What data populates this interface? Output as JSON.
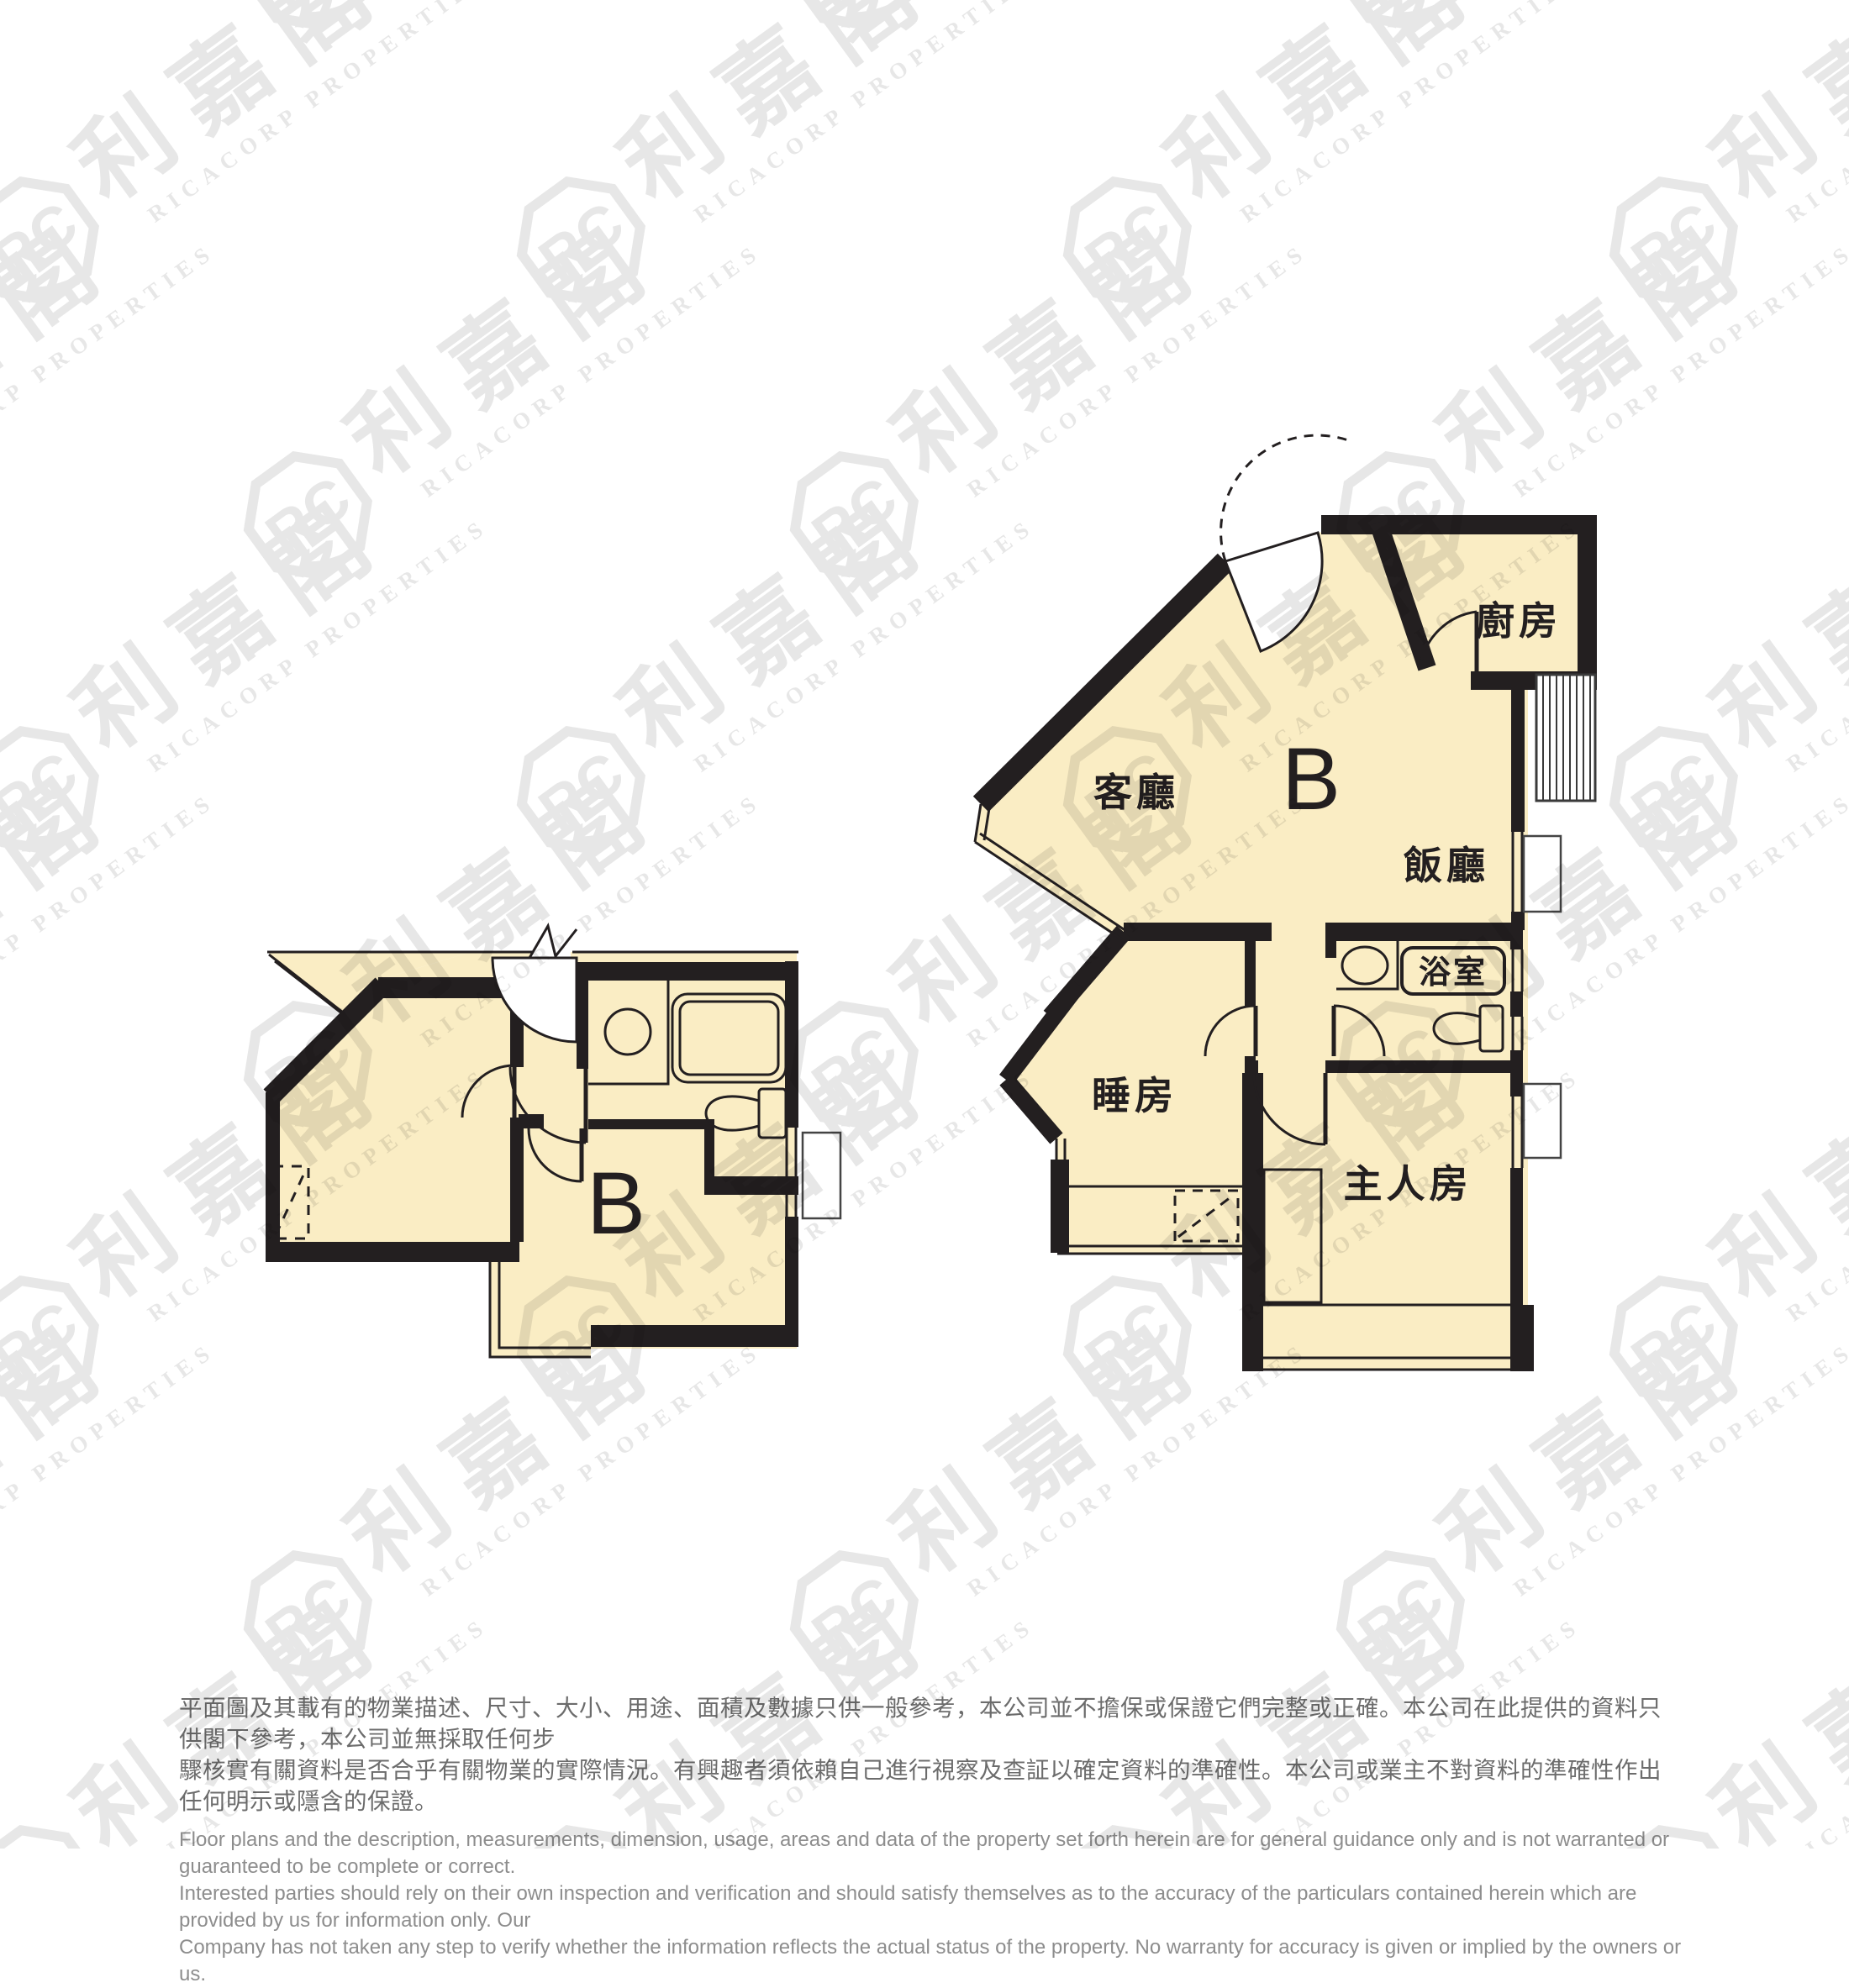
{
  "meta": {
    "background": "#ffffff",
    "wall_color": "#231f20",
    "floor_fill": "#faedc4",
    "thin_line_color": "#231f20",
    "watermark_color": "#e7e7e7",
    "disclaimer_zh_color": "#6c6c6c",
    "disclaimer_en_color": "#8d8d8d"
  },
  "watermark": {
    "logo_monogram": "RC",
    "company_name_cjk": "利嘉閣",
    "subtitle": "RICACORP PROPERTIES"
  },
  "plans": {
    "left": {
      "unit_label": "B"
    },
    "right": {
      "unit_label": "B",
      "rooms": {
        "kitchen": "廚房",
        "living": "客廳",
        "dining": "飯廳",
        "bathroom": "浴室",
        "bedroom": "睡房",
        "master": "主人房"
      }
    }
  },
  "disclaimer": {
    "zh": [
      "平面圖及其載有的物業描述、尺寸、大小、用途、面積及數據只供一般參考，本公司並不擔保或保證它們完整或正確。本公司在此提供的資料只供閣下參考，本公司並無採取任何步",
      "驟核實有關資料是否合乎有關物業的實際情況。有興趣者須依賴自己進行視察及查証以確定資料的準確性。本公司或業主不對資料的準確性作出任何明示或隱含的保證。"
    ],
    "en": [
      "Floor plans and the description, measurements, dimension, usage, areas and data of the property set forth herein are for general guidance only and is not warranted or guaranteed to be complete or correct.",
      "Interested parties should rely on their own inspection and verification and should satisfy themselves as to the accuracy of the particulars contained herein which are provided by us for information only.  Our",
      "Company has not taken any step to verify whether the information reflects the actual status of the property.  No warranty for accuracy is given or implied by the owners or us."
    ]
  }
}
